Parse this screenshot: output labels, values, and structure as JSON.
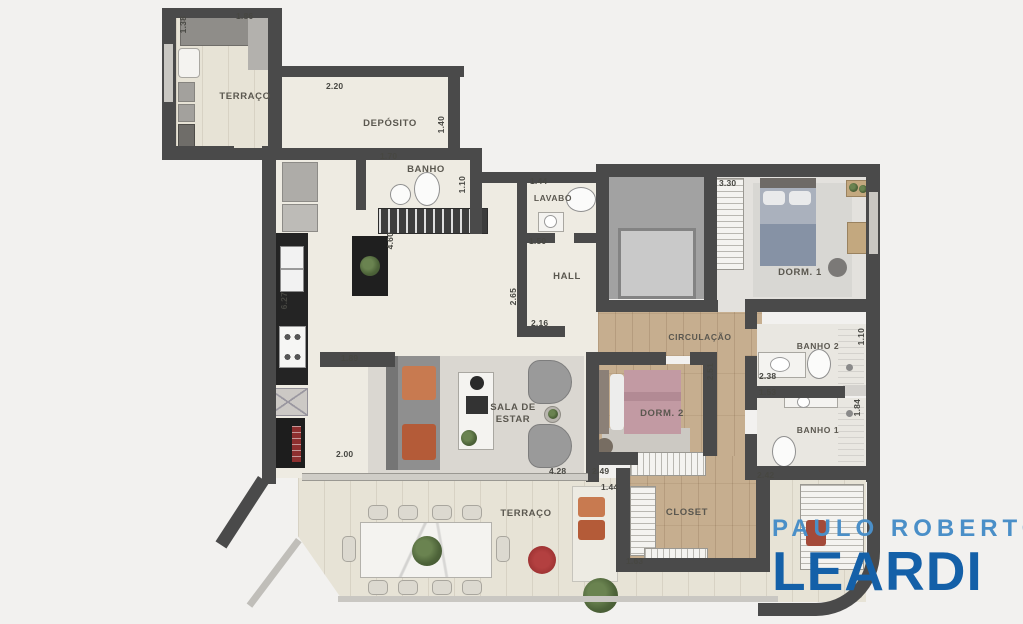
{
  "brand": {
    "line1": "PAULO ROBERTO",
    "line2": "LEARDI",
    "color_line1": "#4a8fc8",
    "color_line2": "#1460a8"
  },
  "plan": {
    "rooms": {
      "terraco_top": "TERRAÇO",
      "deposito": "DEPÓSITO",
      "banho": "BANHO",
      "lavabo": "LAVABO",
      "hall": "HALL",
      "dorm1": "DORM. 1",
      "circulacao": "CIRCULAÇÃO",
      "banho2": "BANHO 2",
      "dorm2": "DORM. 2",
      "banho1": "BANHO 1",
      "sala": "SALA DE ESTAR",
      "closet": "CLOSET",
      "terraco_bottom": "TERRAÇO"
    },
    "measurements": [
      "1.38",
      "1.86",
      "2.20",
      "1.40",
      "1.70",
      "1.10",
      "1.44",
      "1.50",
      "2.65",
      "2.16",
      "4.60",
      "6.27",
      "1.89",
      "2.00",
      "3.30",
      "2.51",
      "2.38",
      "1.10",
      "1.53",
      "1.84",
      "2.42",
      "4.28",
      "2.49",
      "1.44",
      "1.63"
    ],
    "colors": {
      "wall": "#4a4a4a",
      "wood_floor": "#c6ae8f",
      "terrace_floor": "#e7e3d6",
      "interior_floor": "#eeebe2",
      "accent_orange": "#c87a50",
      "accent_red": "#a23131",
      "bed_pink": "#c29aa3",
      "bed_blue": "#8692a5",
      "plant_green": "#4d6339"
    }
  }
}
